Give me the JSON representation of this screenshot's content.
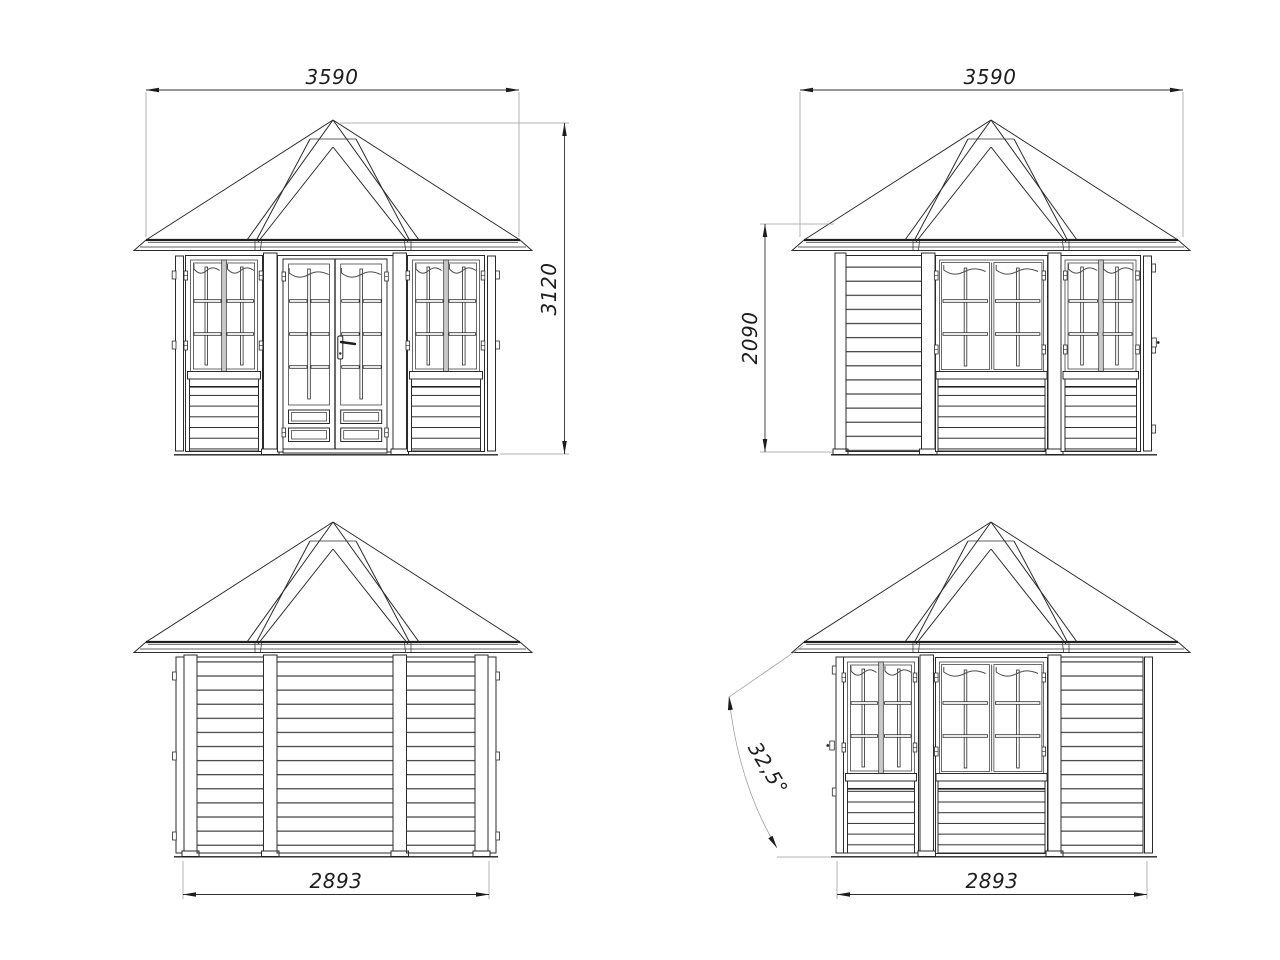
{
  "drawing": {
    "background": "#ffffff",
    "line_color": "#2b2b2b",
    "views": {
      "front": {
        "width_label": "3590",
        "height_label": "3120"
      },
      "side_right": {
        "width_label": "3590",
        "height_label": "2090"
      },
      "back": {
        "width_label": "2893"
      },
      "side_left": {
        "width_label": "2893",
        "angle_label": "32,5°"
      }
    }
  }
}
